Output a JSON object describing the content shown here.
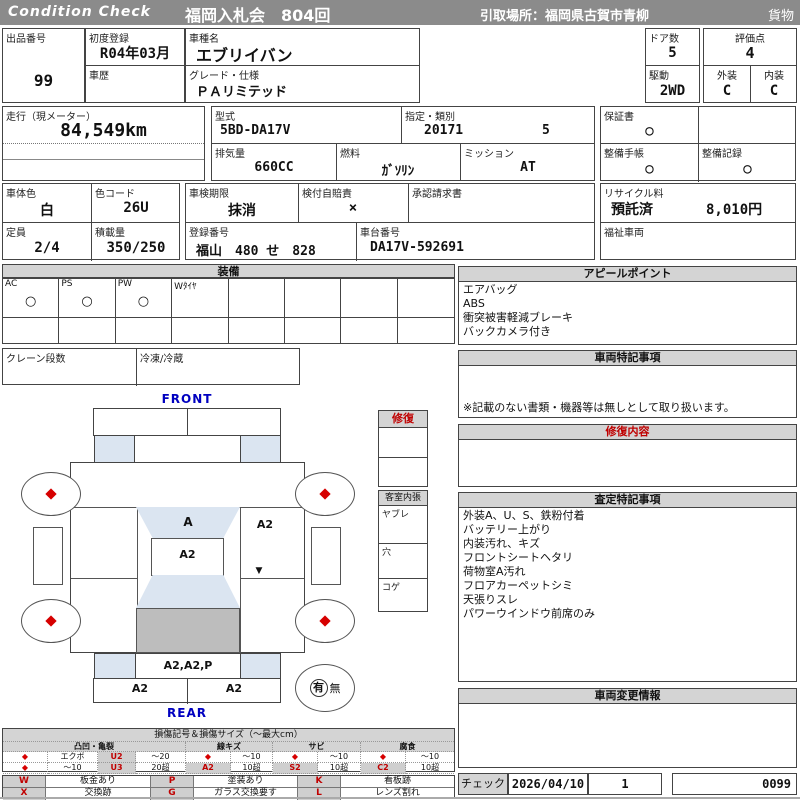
{
  "header": {
    "brand": "Condition  Check",
    "auction": "福岡入札会　804回",
    "pickup": "引取場所：福岡県古賀市青柳",
    "category": "貨物"
  },
  "info": {
    "lot_label": "出品番号",
    "lot_value": "99",
    "first_reg_label": "初度登録",
    "first_reg_value": "R04年03月",
    "history_label": "車歴",
    "history_value": "",
    "model_name_label": "車種名",
    "model_name_value": "エブリイバン",
    "grade_label": "グレード・仕様",
    "grade_value": "ＰＡリミテッド",
    "doors_label": "ドア数",
    "doors_value": "5",
    "score_label": "評価点",
    "score_value": "4",
    "drive_label": "駆動",
    "drive_value": "2WD",
    "exterior_label": "外装",
    "exterior_value": "C",
    "interior_label": "内装",
    "interior_value": "C",
    "mileage_label": "走行（現メーター）",
    "mileage_value": "84,549km",
    "model_code_label": "型式",
    "model_code_value": "5BD-DA17V",
    "class_label": "指定・類別",
    "class_value1": "20171",
    "class_value2": "5",
    "displacement_label": "排気量",
    "displacement_value": "660CC",
    "fuel_label": "燃料",
    "fuel_value": "ｶﾞｿﾘﾝ",
    "transmission_label": "ミッション",
    "transmission_value": "AT",
    "warranty_label": "保証書",
    "warranty_value": "○",
    "maintenance_book_label": "整備手帳",
    "maintenance_book_value": "○",
    "maintenance_record_label": "整備記録",
    "maintenance_record_value": "○",
    "body_color_label": "車体色",
    "body_color_value": "白",
    "color_code_label": "色コード",
    "color_code_value": "26U",
    "inspection_label": "車検期限",
    "inspection_value": "抹消",
    "insurance_label": "検付自賠責",
    "insurance_value": "×",
    "approval_label": "承認請求書",
    "approval_value": "",
    "recycle_label": "リサイクル料",
    "recycle_status": "預託済",
    "recycle_fee": "8,010円",
    "capacity_label": "定員",
    "capacity_value": "2/4",
    "load_label": "積載量",
    "load_value": "350/250",
    "reg_number_label": "登録番号",
    "reg_number_value": "福山　480 せ　828",
    "chassis_label": "車台番号",
    "chassis_value": "DA17V-592691",
    "welfare_label": "福祉車両",
    "welfare_value": ""
  },
  "equipment": {
    "title": "装備",
    "items": [
      {
        "label": "AC",
        "value": "○"
      },
      {
        "label": "PS",
        "value": "○"
      },
      {
        "label": "PW",
        "value": "○"
      },
      {
        "label": "Wﾀｲﾔ",
        "value": ""
      },
      {
        "label": "",
        "value": ""
      },
      {
        "label": "",
        "value": ""
      },
      {
        "label": "",
        "value": ""
      },
      {
        "label": "",
        "value": ""
      }
    ],
    "crane_label": "クレーン段数",
    "crane_value": "",
    "freezer_label": "冷凍/冷蔵",
    "freezer_value": ""
  },
  "diagram": {
    "front_label": "FRONT",
    "rear_label": "REAR",
    "windshield_mark": "A",
    "roof_mark": "A2",
    "side_panel_mark": "A2",
    "side_small_mark": "▼",
    "rear_gate_mark": "A2,A2,P",
    "rear_bumper_left_mark": "A2",
    "rear_bumper_right_mark": "A2",
    "spare_has": "有",
    "spare_none": "無"
  },
  "repair_box": {
    "title": "修復"
  },
  "cabin_box": {
    "title": "客室内張",
    "rows": [
      "ヤブレ",
      "穴",
      "コゲ"
    ]
  },
  "right_panel": {
    "appeal_title": "アピールポイント",
    "appeal_lines": [
      "エアバッグ",
      "ABS",
      "衝突被害軽減ブレーキ",
      "バックカメラ付き"
    ],
    "vehicle_notes_title": "車両特記事項",
    "vehicle_notes_footer": "※記載のない書類・機器等は無しとして取り扱います。",
    "repair_detail_title": "修復内容",
    "assessment_title": "査定特記事項",
    "assessment_lines": [
      "外装A、U、S、鉄粉付着",
      "バッテリー上がり",
      "内装汚れ、キズ",
      "フロントシートヘタリ",
      "荷物室A汚れ",
      "フロアカーペットシミ",
      "天張りスレ",
      "パワーウインドウ前席のみ"
    ],
    "change_title": "車両変更情報",
    "check_label": "チェック",
    "check_date": "2026/04/10",
    "check_num": "1",
    "sheet_no": "0099"
  },
  "legend": {
    "title": "損傷記号＆損傷サイズ（～最大cm）",
    "diamond": "◆",
    "groups": [
      "凸凹・亀裂",
      "線キズ",
      "サビ",
      "腐食"
    ],
    "row1": {
      "dent_kind": "エクボ",
      "dent_code": "U2",
      "dent_size": "～20",
      "scratch_size": "～10",
      "rust_size": "～10",
      "corrosion_size": "～10"
    },
    "row2": {
      "dent_kind": "～10",
      "dent_code": "U3",
      "dent_size": "20超",
      "scratch_code": "A2",
      "scratch_size": "10超",
      "rust_code": "S2",
      "rust_size": "10超",
      "corrosion_code": "C2",
      "corrosion_size": "10超"
    },
    "marks": [
      {
        "code": "W",
        "desc": "板金あり"
      },
      {
        "code": "P",
        "desc": "塗装あり"
      },
      {
        "code": "K",
        "desc": "看板跡"
      },
      {
        "code": "X",
        "desc": "交換跡"
      },
      {
        "code": "G",
        "desc": "ガラス交換要す"
      },
      {
        "code": "L",
        "desc": "レンズ割れ"
      }
    ]
  }
}
